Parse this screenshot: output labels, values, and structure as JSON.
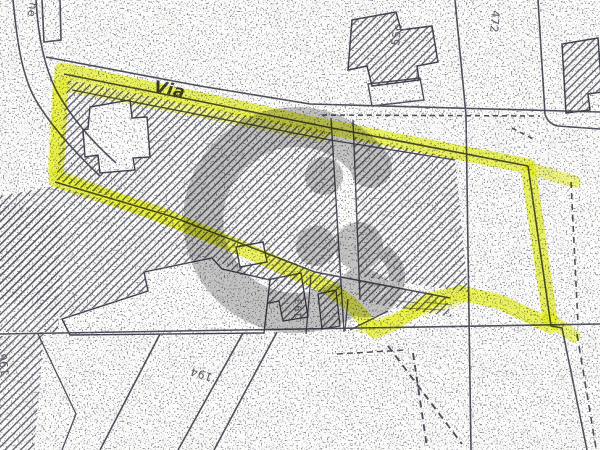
{
  "labels": {
    "street": "Via",
    "street_side_fragment": "ne",
    "road_number": "472",
    "building_number": "55c",
    "parcel_193": "193",
    "parcel_194": "194",
    "parcel_196": "196"
  },
  "highlight": {
    "meaning": "yellow-highlighter-outline-of-parcel"
  },
  "colors": {
    "paper": "#fcfcfa",
    "ink": "#3c3c49",
    "hatch": "#50505c",
    "highlighter": "#e3ef00",
    "highlighter_soft": "#eef626",
    "watermark": "#8d8d8d"
  }
}
